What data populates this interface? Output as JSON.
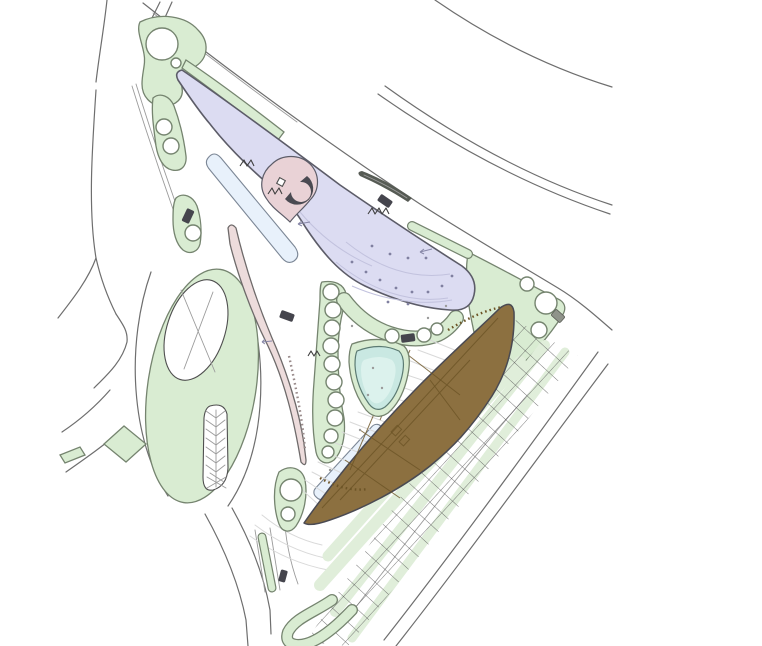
{
  "palette": {
    "background": "#ffffff",
    "green_fill": "#d9ecd2",
    "green_stroke": "#75846f",
    "pale_green": "#e0eeda",
    "lavender_fill": "#dcdcf2",
    "lavender_stroke": "#5c5c68",
    "lavender_detail": "#c2c2de",
    "lavender_dot": "#8080a0",
    "blue_fill": "#e8f1fb",
    "blue_stroke": "#7c8796",
    "pink_fill": "#eddcdc",
    "pink_stroke": "#6e6a6a",
    "plaza_pink": "#e9d2d6",
    "teal_fill": "#c9e8e2",
    "teal_inner": "#dcf2ed",
    "teal_stroke": "#5b7a72",
    "brown_fill": "#8c7040",
    "brown_line": "#6c5426",
    "outline_dark": "#4a4a52",
    "road_line": "#6e6e6e",
    "detail_line": "#9b9b9b",
    "faint_line": "#d9d9d9",
    "canopy_dark": "#565b54",
    "car_dark": "#45454d",
    "car_grey": "#8f938a",
    "mark_dark": "#3f3f3f",
    "arrow_line": "#8888a8"
  }
}
